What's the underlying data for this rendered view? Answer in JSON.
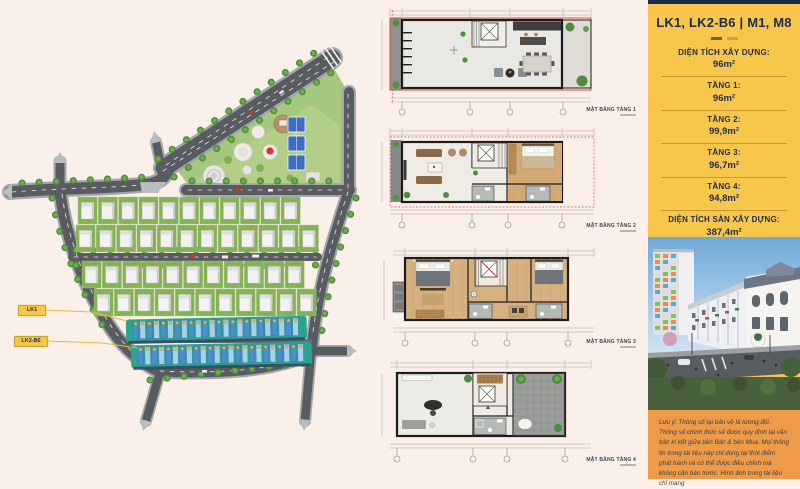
{
  "site_plan": {
    "callouts": [
      {
        "text": "LK1"
      },
      {
        "text": "LK2-B6"
      }
    ]
  },
  "floor_plans": [
    {
      "label": "MẶT BẰNG TẦNG 1"
    },
    {
      "label": "MẶT BẰNG TẦNG 2"
    },
    {
      "label": "MẶT BẰNG TẦNG 3"
    },
    {
      "label": "MẶT BẰNG TẦNG 4"
    }
  ],
  "info_panel": {
    "title": "LK1, LK2-B6  |  M1, M8",
    "specs": [
      {
        "label": "DIỆN TÍCH XÂY DỰNG:",
        "value": "96m²"
      },
      {
        "label": "TẦNG 1:",
        "value": "96m²"
      },
      {
        "label": "TẦNG 2:",
        "value": "99,9m²"
      },
      {
        "label": "TẦNG 3:",
        "value": "96,7m²"
      },
      {
        "label": "TẦNG 4:",
        "value": "94,8m²"
      },
      {
        "label": "DIỆN TÍCH SÀN XÂY DỰNG:",
        "value": "387,4m²"
      }
    ],
    "note": "Lưu ý: Thông số tại bản vẽ là tương đối. Thông số chính thức sẽ được quy định tại văn bản kí kết giữa bên Bán & bên Mua. Mọi thông tin trong tài liệu này chỉ dùng tại thời điểm phát hành và có thể được điều chỉnh mà không cần báo trước. Hình ảnh trong tài liệu chỉ mang",
    "colors": {
      "panel": "#f8c64a",
      "navy": "#1c2c4d",
      "note_bg": "#ee9a47",
      "divider": "#c8992f"
    }
  }
}
